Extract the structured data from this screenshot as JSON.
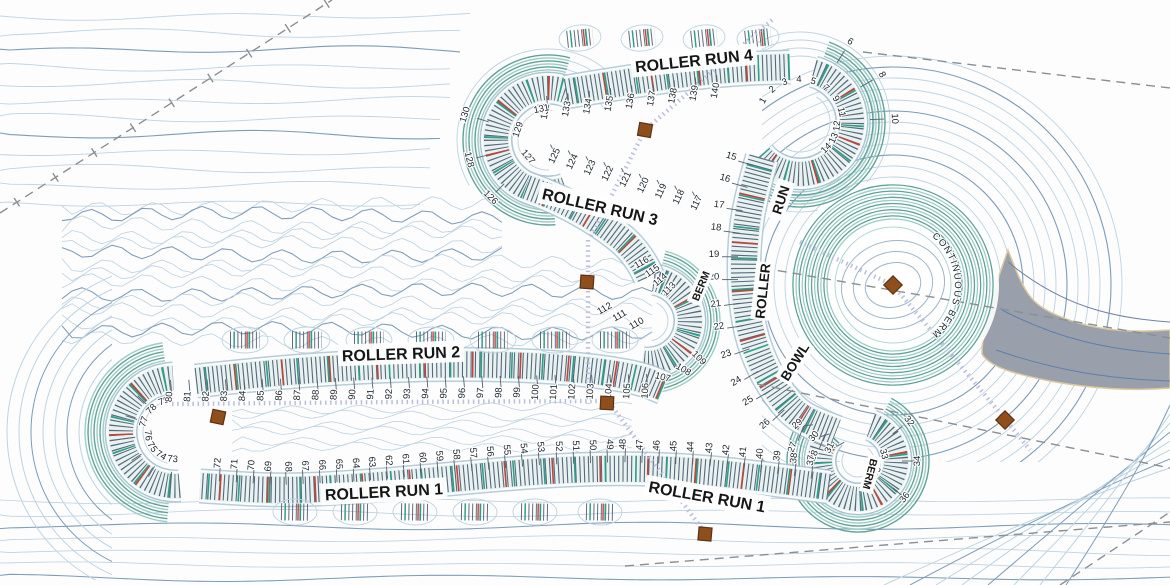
{
  "plan": {
    "type": "pump-track-grading-plan"
  },
  "labels": {
    "run4": "ROLLER RUN 4",
    "run3": "ROLLER RUN 3",
    "run2": "ROLLER RUN 2",
    "run1_left": "ROLLER RUN 1",
    "run1_right": "ROLLER RUN 1",
    "bowl_run_words": [
      "RUN",
      "ROLLER",
      "BOWL"
    ],
    "berm_mid": "BERM",
    "berm_right": "BERM",
    "continuous_berm": "CONTINUOUS BERM"
  },
  "stations": {
    "run4": [
      "132",
      "133",
      "134",
      "135",
      "136",
      "137",
      "138",
      "139",
      "140"
    ],
    "loop_top_right_inner": [
      "1",
      "2",
      "3",
      "4",
      "5",
      "7",
      "9",
      "11",
      "12",
      "13",
      "14"
    ],
    "loop_top_right_outer": [
      "6",
      "8",
      "10"
    ],
    "bowl_run": [
      "15",
      "16",
      "17",
      "18",
      "19",
      "20",
      "21",
      "22",
      "23",
      "24",
      "25",
      "26",
      "27",
      "28"
    ],
    "loop_bottom_right_entry": [
      "29",
      "30",
      "31"
    ],
    "loop_bottom_right_inner": [
      "33",
      "35"
    ],
    "loop_bottom_right_outer": [
      "32",
      "34",
      "36"
    ],
    "run1": [
      "37",
      "38",
      "39",
      "40",
      "41",
      "42",
      "43",
      "44",
      "45",
      "46",
      "47",
      "48",
      "49",
      "50",
      "51",
      "52",
      "53",
      "54",
      "55",
      "56",
      "57",
      "58",
      "59",
      "60",
      "61",
      "62",
      "63",
      "64",
      "65",
      "66",
      "67",
      "68",
      "69",
      "70",
      "71",
      "72"
    ],
    "loop_left": [
      "73",
      "74",
      "75",
      "76",
      "77",
      "78",
      "79"
    ],
    "run2": [
      "80",
      "81",
      "82",
      "83",
      "84",
      "85",
      "86",
      "87",
      "88",
      "89",
      "90",
      "91",
      "92",
      "93",
      "94",
      "95",
      "96",
      "97",
      "98",
      "99",
      "100",
      "101",
      "102",
      "103",
      "104",
      "105",
      "106"
    ],
    "loop_mid": [
      "107",
      "108",
      "109",
      "110",
      "111",
      "112",
      "113",
      "114",
      "115",
      "116"
    ],
    "run3": [
      "117",
      "118",
      "119",
      "120",
      "121",
      "122",
      "123",
      "124",
      "125"
    ],
    "loop_top_left_outer": [
      "126",
      "128",
      "130"
    ],
    "loop_top_left_inner": [
      "127",
      "129",
      "131"
    ]
  },
  "markers": [
    {
      "x": 645,
      "y": 130,
      "rot": 10,
      "shape": "square"
    },
    {
      "x": 587,
      "y": 282,
      "rot": 4,
      "shape": "square"
    },
    {
      "x": 218,
      "y": 417,
      "rot": 12,
      "shape": "square"
    },
    {
      "x": 607,
      "y": 403,
      "rot": 3,
      "shape": "square"
    },
    {
      "x": 705,
      "y": 534,
      "rot": 5,
      "shape": "square"
    },
    {
      "x": 893,
      "y": 285,
      "rot": 45,
      "shape": "diamond"
    },
    {
      "x": 1005,
      "y": 420,
      "rot": 45,
      "shape": "diamond"
    }
  ],
  "colors": {
    "track_hatch": "#44546b",
    "track_teal": "#5fa39a",
    "track_teal_light": "#9ccdc4",
    "accent_red": "#c0453a",
    "accent_green": "#2f9e88",
    "contour_light": "#bdd3e2",
    "contour_dark": "#7d9cb8",
    "marker_brown": "#8f4f1d",
    "marker_edge": "#5f3212",
    "section_line": "#b6bcdb",
    "boundary_gray": "#8a8f94",
    "funnel_gray": "#9aa0ab",
    "funnel_edge": "#dcc89e",
    "label_ink": "#161616"
  }
}
